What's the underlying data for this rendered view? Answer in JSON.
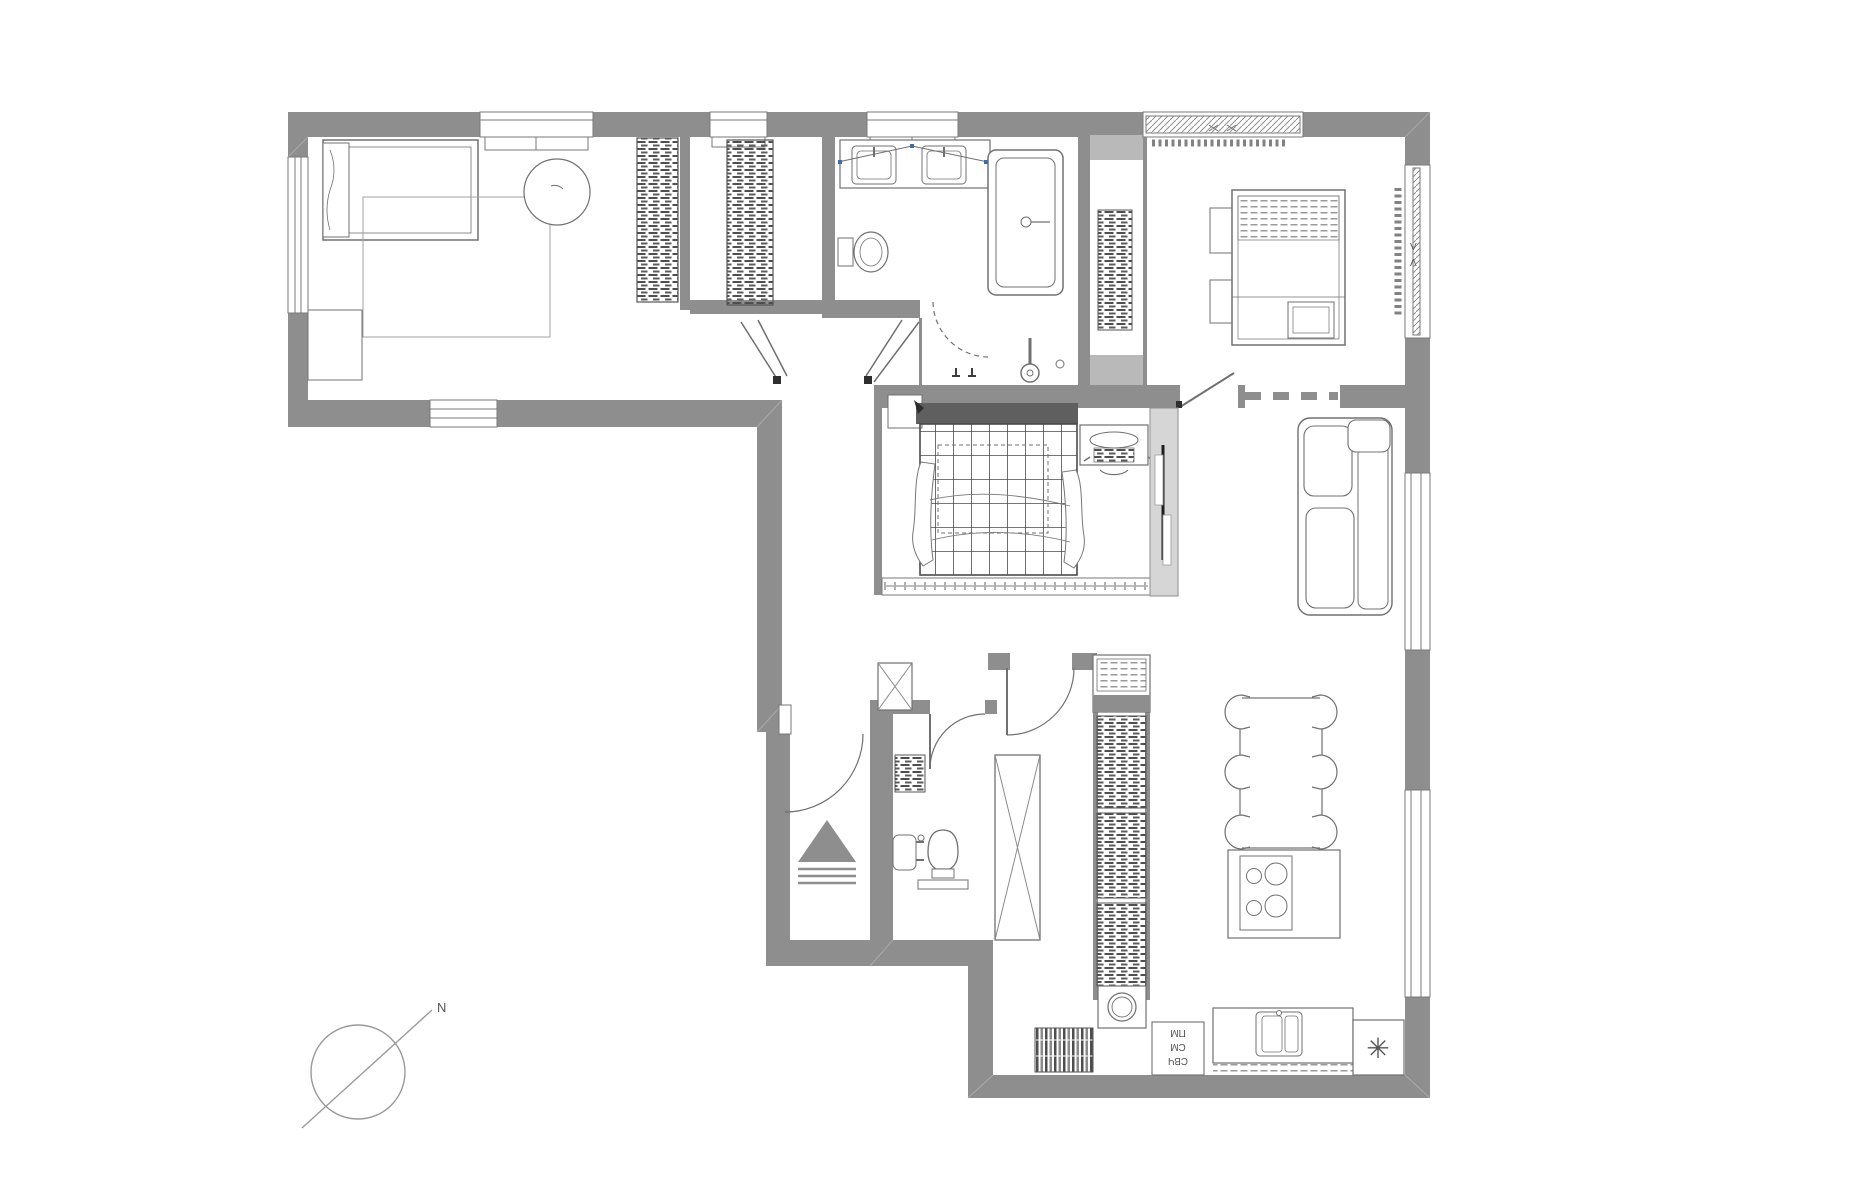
{
  "palette": {
    "background": "#ffffff",
    "wall": "#8e8e8e",
    "wall_light": "#c9c9c9",
    "line": "#707070",
    "line_light": "#9a9a9a",
    "dark_fill": "#565656",
    "accent_blue": "#3a6ea8"
  },
  "labels": {
    "compass_north": "N",
    "window_mark_upper": "V",
    "window_mark_lower": "Λ",
    "fridge_snowflake": "✳",
    "appliance_stack": {
      "rotation_deg": 180,
      "line1": "ПМ",
      "line2": "СМ",
      "line3": "СВЧ"
    }
  }
}
